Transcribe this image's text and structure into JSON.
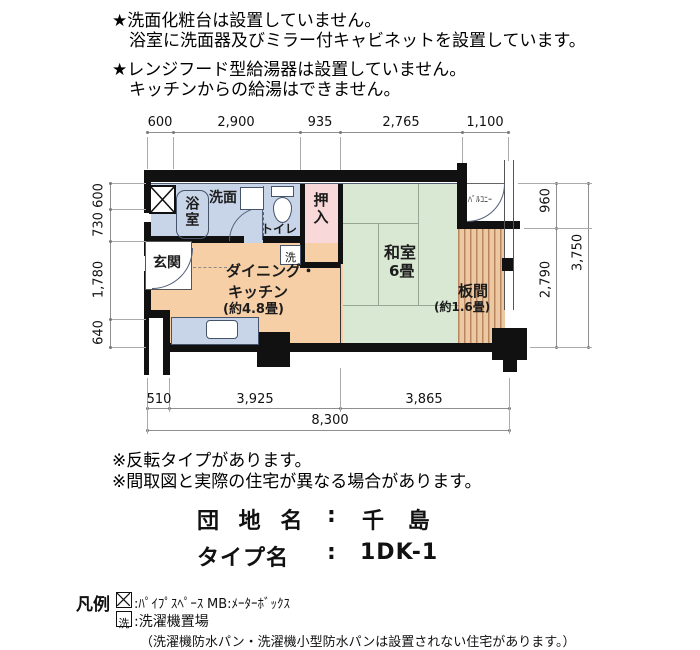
{
  "notices": {
    "a1": "★洗面化粧台は設置していません。",
    "a2": "浴室に洗面器及びミラー付キャビネットを設置しています。",
    "b1": "★レンジフード型給湯器は設置していません。",
    "b2": "キッチンからの給湯はできません。"
  },
  "plan": {
    "rooms": {
      "bath": "浴室",
      "washroom": "洗面",
      "toilet": "トイレ",
      "closet": "押入",
      "washer": "洗",
      "entrance": "玄関",
      "dk1": "ダイニング・",
      "dk2": "キッチン",
      "dk3": "(約4.8畳)",
      "jroom1": "和室",
      "jroom2": "6畳",
      "wood1": "板間",
      "wood2": "(約1.6畳)",
      "balcony": "ﾊﾞﾙｺﾆｰ"
    },
    "dims": {
      "top": [
        "600",
        "2,900",
        "935",
        "2,765",
        "1,100"
      ],
      "left": [
        "600",
        "730",
        "1,780",
        "640"
      ],
      "right": [
        "960",
        "2,790",
        "3,750"
      ],
      "bottom": [
        "510",
        "3,925",
        "3,865",
        "8,300"
      ]
    }
  },
  "remarks": {
    "r1": "※反転タイプがあります。",
    "r2": "※間取図と実際の住宅が異なる場合があります。"
  },
  "property": {
    "danchi_label": "団 地 名",
    "colon": ":",
    "danchi_value": "千 島",
    "type_label": "タイプ名",
    "type_value": "1DK-1"
  },
  "legend": {
    "title": "凡例",
    "ps_text": ":ﾊﾟｲﾌﾟｽﾍﾟｰｽ",
    "mb_text": "MB:ﾒｰﾀｰﾎﾞｯｸｽ",
    "washer_symbol": "洗",
    "washer_text": ":洗濯機置場",
    "note": "（洗濯機防水パン・洗濯機小型防水パンは設置されない住宅があります。）"
  },
  "colors": {
    "bath_blue": "#c8d5e8",
    "tatami_green": "#d8e8d2",
    "dk_peach": "#f7cfa6",
    "closet_pink": "#f8d8d8",
    "wood": "#ecc9a2",
    "wood_line": "#b9875f",
    "wall": "#111111"
  }
}
